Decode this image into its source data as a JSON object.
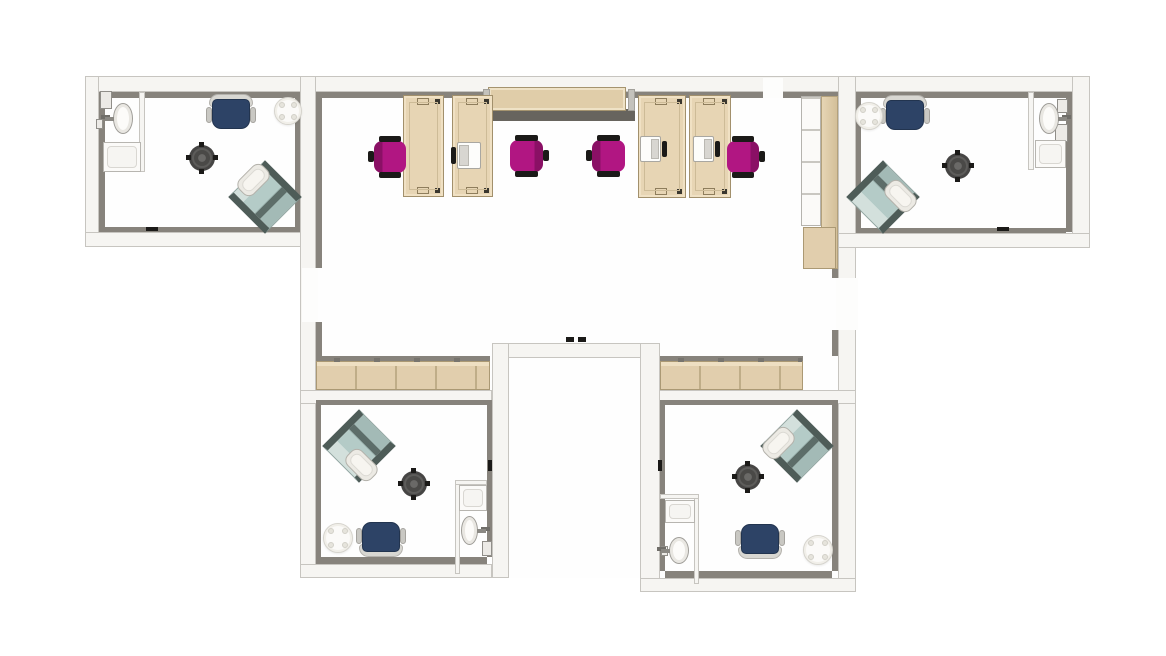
{
  "title": "office-floor-plan",
  "palette": {
    "wall": "#f6f5f2",
    "wallBorder": "#c7c5c0",
    "shade": "#87837c",
    "floor": "#fefefe",
    "tan": "#e7d5b4",
    "tanBorder": "#a2906c",
    "tanRow": "#e1cead",
    "tanSeg": "#bfad88",
    "band": "#67645e",
    "magenta": "#b11682",
    "magentaDark": "#8a1065",
    "ink": "#1b1a18",
    "navy": "#2d4366",
    "backGray": "#d8d7d2",
    "teal": "#b4cbc7",
    "tealLight": "#d3e0dc",
    "tealBar": "#4e5c58",
    "tealStripe": "#5d6d69",
    "tblDark": "#464544",
    "tblRing": "#5d5c5a",
    "white": "#fbfaf8"
  },
  "rooms": [
    {
      "name": "office-top-left"
    },
    {
      "name": "open-office-center"
    },
    {
      "name": "office-top-right"
    },
    {
      "name": "office-bottom-left"
    },
    {
      "name": "office-bottom-right"
    },
    {
      "name": "corridor"
    }
  ],
  "structure": [
    {
      "kind": "floor",
      "name": "floor-office-top-left",
      "x": 99,
      "y": 92,
      "w": 201,
      "h": 140
    },
    {
      "kind": "floor",
      "name": "floor-open-office",
      "x": 316,
      "y": 92,
      "w": 522,
      "h": 298
    },
    {
      "kind": "floor",
      "name": "floor-office-top-right",
      "x": 856,
      "y": 92,
      "w": 216,
      "h": 141
    },
    {
      "kind": "floor",
      "name": "floor-office-bottom-left",
      "x": 316,
      "y": 400,
      "w": 171,
      "h": 164
    },
    {
      "kind": "floor",
      "name": "floor-office-bottom-right",
      "x": 660,
      "y": 400,
      "w": 178,
      "h": 178
    },
    {
      "kind": "floor",
      "name": "floor-corridor",
      "x": 509,
      "y": 358,
      "w": 131,
      "h": 220
    },
    {
      "kind": "wall",
      "name": "wall-top",
      "x": 85,
      "y": 76,
      "w": 1005,
      "h": 16
    },
    {
      "kind": "wall",
      "name": "wall-left-wing-west",
      "x": 85,
      "y": 76,
      "w": 14,
      "h": 171
    },
    {
      "kind": "wall",
      "name": "wall-left-wing-south",
      "x": 85,
      "y": 232,
      "w": 231,
      "h": 15
    },
    {
      "kind": "wall",
      "name": "wall-spine-west",
      "x": 300,
      "y": 76,
      "w": 16,
      "h": 502
    },
    {
      "kind": "wall",
      "name": "wall-spine-east",
      "x": 838,
      "y": 76,
      "w": 18,
      "h": 516
    },
    {
      "kind": "wall",
      "name": "wall-right-wing-east",
      "x": 1072,
      "y": 76,
      "w": 18,
      "h": 172
    },
    {
      "kind": "wall",
      "name": "wall-right-wing-south",
      "x": 838,
      "y": 233,
      "w": 252,
      "h": 15
    },
    {
      "kind": "wall",
      "name": "wall-open-office-south-left",
      "x": 300,
      "y": 390,
      "w": 192,
      "h": 14
    },
    {
      "kind": "wall",
      "name": "wall-open-office-south-right",
      "x": 658,
      "y": 390,
      "w": 198,
      "h": 14
    },
    {
      "kind": "wall",
      "name": "wall-corridor-top",
      "x": 492,
      "y": 343,
      "w": 166,
      "h": 15
    },
    {
      "kind": "wall",
      "name": "wall-corridor-west",
      "x": 492,
      "y": 343,
      "w": 17,
      "h": 235
    },
    {
      "kind": "wall",
      "name": "wall-corridor-east",
      "x": 640,
      "y": 343,
      "w": 20,
      "h": 249
    },
    {
      "kind": "wall",
      "name": "wall-bottom-left-south",
      "x": 300,
      "y": 564,
      "w": 192,
      "h": 14
    },
    {
      "kind": "wall",
      "name": "wall-bottom-right-south",
      "x": 640,
      "y": 578,
      "w": 216,
      "h": 14
    },
    {
      "kind": "shade",
      "name": "wall-shadow",
      "x": 99,
      "y": 92,
      "w": 201,
      "h": 6
    },
    {
      "kind": "shade",
      "name": "wall-shadow",
      "x": 99,
      "y": 92,
      "w": 6,
      "h": 137
    },
    {
      "kind": "shade",
      "name": "wall-shadow",
      "x": 99,
      "y": 227,
      "w": 201,
      "h": 5
    },
    {
      "kind": "shade",
      "name": "wall-shadow",
      "x": 295,
      "y": 92,
      "w": 5,
      "h": 140
    },
    {
      "kind": "shade",
      "name": "wall-shadow",
      "x": 316,
      "y": 92,
      "w": 447,
      "h": 6
    },
    {
      "kind": "shade",
      "name": "wall-shadow",
      "x": 783,
      "y": 92,
      "w": 55,
      "h": 6
    },
    {
      "kind": "shade",
      "name": "wall-shadow",
      "x": 316,
      "y": 92,
      "w": 6,
      "h": 176
    },
    {
      "kind": "shade",
      "name": "wall-shadow",
      "x": 316,
      "y": 322,
      "w": 6,
      "h": 34
    },
    {
      "kind": "shade",
      "name": "wall-shadow",
      "x": 832,
      "y": 92,
      "w": 6,
      "h": 186
    },
    {
      "kind": "shade",
      "name": "wall-shadow",
      "x": 832,
      "y": 330,
      "w": 6,
      "h": 26
    },
    {
      "kind": "shade",
      "name": "credenza-shadow-left",
      "x": 316,
      "y": 356,
      "w": 174,
      "h": 5
    },
    {
      "kind": "shade",
      "name": "credenza-shadow-right",
      "x": 660,
      "y": 356,
      "w": 143,
      "h": 5
    },
    {
      "kind": "shade",
      "name": "wall-shadow",
      "x": 856,
      "y": 92,
      "w": 210,
      "h": 6
    },
    {
      "kind": "shade",
      "name": "wall-shadow",
      "x": 1066,
      "y": 92,
      "w": 6,
      "h": 140
    },
    {
      "kind": "shade",
      "name": "wall-shadow",
      "x": 856,
      "y": 228,
      "w": 210,
      "h": 5
    },
    {
      "kind": "shade",
      "name": "wall-shadow",
      "x": 856,
      "y": 92,
      "w": 5,
      "h": 140
    },
    {
      "kind": "shade",
      "name": "wall-shadow",
      "x": 316,
      "y": 400,
      "w": 171,
      "h": 5
    },
    {
      "kind": "shade",
      "name": "wall-shadow",
      "x": 316,
      "y": 400,
      "w": 5,
      "h": 160
    },
    {
      "kind": "shade",
      "name": "wall-shadow",
      "x": 316,
      "y": 557,
      "w": 171,
      "h": 7
    },
    {
      "kind": "shade",
      "name": "wall-shadow",
      "x": 487,
      "y": 400,
      "w": 5,
      "h": 157
    },
    {
      "kind": "shade",
      "name": "wall-shadow",
      "x": 665,
      "y": 400,
      "w": 167,
      "h": 5
    },
    {
      "kind": "shade",
      "name": "wall-shadow",
      "x": 832,
      "y": 400,
      "w": 6,
      "h": 171
    },
    {
      "kind": "shade",
      "name": "wall-shadow",
      "x": 665,
      "y": 571,
      "w": 167,
      "h": 7
    },
    {
      "kind": "shade",
      "name": "wall-shadow",
      "x": 660,
      "y": 400,
      "w": 5,
      "h": 171
    },
    {
      "kind": "gap",
      "name": "door-opening-west",
      "x": 302,
      "y": 268,
      "w": 16,
      "h": 54
    },
    {
      "kind": "gap",
      "name": "door-opening-east",
      "x": 836,
      "y": 278,
      "w": 22,
      "h": 52
    },
    {
      "kind": "gap",
      "name": "door-opening-top",
      "x": 763,
      "y": 78,
      "w": 20,
      "h": 20
    },
    {
      "kind": "part",
      "name": "bath-partition-top-left",
      "x": 139,
      "y": 92,
      "w": 6,
      "h": 80
    },
    {
      "kind": "part",
      "name": "bath-partition-top-right",
      "x": 1028,
      "y": 92,
      "w": 6,
      "h": 78
    },
    {
      "kind": "part",
      "name": "bath-partition-bottom-left-v",
      "x": 455,
      "y": 480,
      "w": 5,
      "h": 94
    },
    {
      "kind": "part",
      "name": "bath-partition-bottom-left-h",
      "x": 455,
      "y": 480,
      "w": 32,
      "h": 5
    },
    {
      "kind": "part",
      "name": "bath-partition-bottom-right-v",
      "x": 694,
      "y": 494,
      "w": 5,
      "h": 90
    },
    {
      "kind": "part",
      "name": "bath-partition-bottom-right-h",
      "x": 660,
      "y": 494,
      "w": 39,
      "h": 5
    },
    {
      "kind": "box",
      "name": "wall-cabinet",
      "x": 100,
      "y": 91,
      "w": 12,
      "h": 18
    },
    {
      "kind": "box",
      "name": "wall-fixture",
      "x": 96,
      "y": 119,
      "w": 7,
      "h": 10
    },
    {
      "kind": "box",
      "name": "wall-cabinet",
      "x": 1057,
      "y": 99,
      "w": 11,
      "h": 14
    },
    {
      "kind": "box",
      "name": "wall-fixture",
      "x": 1055,
      "y": 124,
      "w": 13,
      "h": 18
    },
    {
      "kind": "box",
      "name": "wall-fixture",
      "x": 482,
      "y": 541,
      "w": 10,
      "h": 15
    },
    {
      "kind": "box",
      "name": "wall-fixture",
      "x": 661,
      "y": 546,
      "w": 7,
      "h": 10
    },
    {
      "kind": "mark",
      "name": "door-mark",
      "x": 146,
      "y": 227,
      "w": 12,
      "h": 4
    },
    {
      "kind": "mark",
      "name": "door-mark",
      "x": 997,
      "y": 227,
      "w": 12,
      "h": 4
    },
    {
      "kind": "mark",
      "name": "door-mark",
      "x": 566,
      "y": 337,
      "w": 8,
      "h": 5
    },
    {
      "kind": "mark",
      "name": "door-mark",
      "x": 578,
      "y": 337,
      "w": 8,
      "h": 5
    },
    {
      "kind": "mark",
      "name": "door-mark",
      "x": 488,
      "y": 460,
      "w": 4,
      "h": 11
    },
    {
      "kind": "mark",
      "name": "door-mark",
      "x": 658,
      "y": 460,
      "w": 4,
      "h": 11
    }
  ],
  "furniture": [
    {
      "type": "cabinetRow",
      "name": "credenza-left",
      "x": 316,
      "y": 361,
      "w": 174,
      "h": 29
    },
    {
      "type": "cabinetRow",
      "name": "credenza-right",
      "x": 660,
      "y": 361,
      "w": 143,
      "h": 29
    },
    {
      "type": "ctopBand",
      "name": "media-cabinet-shadow",
      "x": 483,
      "y": 109,
      "w": 152,
      "h": 12
    },
    {
      "type": "ctopBody",
      "name": "media-cabinet",
      "x": 488,
      "y": 87,
      "w": 138,
      "h": 24
    },
    {
      "type": "cap",
      "name": "media-cabinet-end-left",
      "x": 483,
      "y": 89,
      "w": 7,
      "h": 22
    },
    {
      "type": "cap",
      "name": "media-cabinet-end-right",
      "x": 628,
      "y": 89,
      "w": 7,
      "h": 22
    },
    {
      "type": "tallShelf",
      "name": "shelf-unit",
      "x": 801,
      "y": 96,
      "w": 20,
      "h": 130
    },
    {
      "type": "tallCol",
      "name": "tall-cabinet",
      "x": 821,
      "y": 96,
      "w": 17,
      "h": 173
    },
    {
      "type": "tallBlock",
      "name": "low-cabinet",
      "x": 803,
      "y": 227,
      "w": 33,
      "h": 42
    },
    {
      "type": "desk",
      "name": "desk-1",
      "x": 403,
      "y": 95,
      "w": 41,
      "h": 102
    },
    {
      "type": "desk",
      "name": "desk-2",
      "x": 452,
      "y": 95,
      "w": 41,
      "h": 102
    },
    {
      "type": "desk",
      "name": "desk-3",
      "x": 638,
      "y": 95,
      "w": 48,
      "h": 103
    },
    {
      "type": "desk",
      "name": "desk-4",
      "x": 689,
      "y": 95,
      "w": 42,
      "h": 103
    },
    {
      "type": "laptop",
      "name": "laptop-1",
      "x": 457,
      "y": 142,
      "w": 24,
      "h": 27,
      "side": "left"
    },
    {
      "type": "laptop",
      "name": "laptop-2",
      "x": 640,
      "y": 136,
      "w": 21,
      "h": 26,
      "side": "right"
    },
    {
      "type": "laptop",
      "name": "laptop-3",
      "x": 693,
      "y": 136,
      "w": 21,
      "h": 26,
      "side": "right"
    },
    {
      "type": "chairTask",
      "name": "task-chair-1",
      "x": 374,
      "y": 141,
      "w": 32,
      "h": 32,
      "facing": "right"
    },
    {
      "type": "chairTask",
      "name": "task-chair-2",
      "x": 510,
      "y": 140,
      "w": 33,
      "h": 32,
      "facing": "left"
    },
    {
      "type": "chairTask",
      "name": "task-chair-3",
      "x": 592,
      "y": 140,
      "w": 33,
      "h": 32,
      "facing": "right"
    },
    {
      "type": "chairTask",
      "name": "task-chair-4",
      "x": 727,
      "y": 141,
      "w": 32,
      "h": 32,
      "facing": "left"
    },
    {
      "type": "chairArm",
      "name": "armchair-top-left",
      "x": 212,
      "y": 99,
      "w": 38,
      "h": 30,
      "dir": "down"
    },
    {
      "type": "chairArm",
      "name": "armchair-top-right",
      "x": 886,
      "y": 100,
      "w": 38,
      "h": 30,
      "dir": "down"
    },
    {
      "type": "chairArm",
      "name": "armchair-bottom-left",
      "x": 362,
      "y": 522,
      "w": 38,
      "h": 30,
      "dir": "up"
    },
    {
      "type": "chairArm",
      "name": "armchair-bottom-right",
      "x": 741,
      "y": 524,
      "w": 38,
      "h": 30,
      "dir": "up"
    },
    {
      "type": "tableRound",
      "name": "round-table-top-left",
      "x": 274,
      "y": 97,
      "w": 28,
      "h": 28
    },
    {
      "type": "tableRound",
      "name": "round-table-top-right",
      "x": 855,
      "y": 102,
      "w": 28,
      "h": 28
    },
    {
      "type": "tableRound",
      "name": "round-table-bottom-left",
      "x": 323,
      "y": 523,
      "w": 30,
      "h": 30
    },
    {
      "type": "tableRound",
      "name": "round-table-bottom-right",
      "x": 803,
      "y": 535,
      "w": 30,
      "h": 30
    },
    {
      "type": "tableSide",
      "name": "side-table-top-left",
      "x": 189,
      "y": 145,
      "w": 26,
      "h": 26
    },
    {
      "type": "tableSide",
      "name": "side-table-top-right",
      "x": 945,
      "y": 153,
      "w": 26,
      "h": 26
    },
    {
      "type": "tableSide",
      "name": "side-table-bottom-left",
      "x": 401,
      "y": 471,
      "w": 26,
      "h": 26
    },
    {
      "type": "tableSide",
      "name": "side-table-bottom-right",
      "x": 735,
      "y": 464,
      "w": 26,
      "h": 26
    },
    {
      "type": "lounge",
      "name": "lounge-chair-top-left",
      "x": 239,
      "y": 171,
      "w": 52,
      "h": 52,
      "rot": 45
    },
    {
      "type": "ottoman",
      "name": "ottoman-top-left",
      "x": 243,
      "y": 163,
      "w": 21,
      "h": 34,
      "rot": 45
    },
    {
      "type": "lounge",
      "name": "lounge-chair-top-right",
      "x": 857,
      "y": 171,
      "w": 52,
      "h": 52,
      "rot": -45
    },
    {
      "type": "ottoman",
      "name": "ottoman-top-right",
      "x": 890,
      "y": 179,
      "w": 21,
      "h": 34,
      "rot": -45
    },
    {
      "type": "lounge",
      "name": "lounge-chair-bottom-left",
      "x": 333,
      "y": 420,
      "w": 52,
      "h": 52,
      "rot": -45
    },
    {
      "type": "ottoman",
      "name": "ottoman-bottom-left",
      "x": 351,
      "y": 448,
      "w": 21,
      "h": 34,
      "rot": -45
    },
    {
      "type": "lounge",
      "name": "lounge-chair-bottom-right",
      "x": 771,
      "y": 420,
      "w": 52,
      "h": 52,
      "rot": 45
    },
    {
      "type": "ottoman",
      "name": "ottoman-bottom-right",
      "x": 768,
      "y": 426,
      "w": 21,
      "h": 34,
      "rot": 45
    },
    {
      "type": "counter",
      "name": "vanity-counter-top-left",
      "x": 103,
      "y": 142,
      "w": 38,
      "h": 30
    },
    {
      "type": "counter",
      "name": "vanity-counter-top-right",
      "x": 1035,
      "y": 140,
      "w": 31,
      "h": 28
    },
    {
      "type": "counter",
      "name": "vanity-counter-bottom-left",
      "x": 459,
      "y": 485,
      "w": 28,
      "h": 26
    },
    {
      "type": "counter",
      "name": "vanity-counter-bottom-right",
      "x": 665,
      "y": 500,
      "w": 30,
      "h": 23
    },
    {
      "type": "sink",
      "name": "sink-top-left",
      "x": 113,
      "y": 103,
      "w": 20,
      "h": 31,
      "side": "left"
    },
    {
      "type": "sink",
      "name": "sink-top-right",
      "x": 1039,
      "y": 103,
      "w": 20,
      "h": 31,
      "side": "right"
    },
    {
      "type": "sink",
      "name": "sink-bottom-left",
      "x": 461,
      "y": 516,
      "w": 17,
      "h": 29,
      "side": "right"
    },
    {
      "type": "sink",
      "name": "sink-bottom-right",
      "x": 669,
      "y": 537,
      "w": 20,
      "h": 27,
      "side": "left"
    }
  ]
}
